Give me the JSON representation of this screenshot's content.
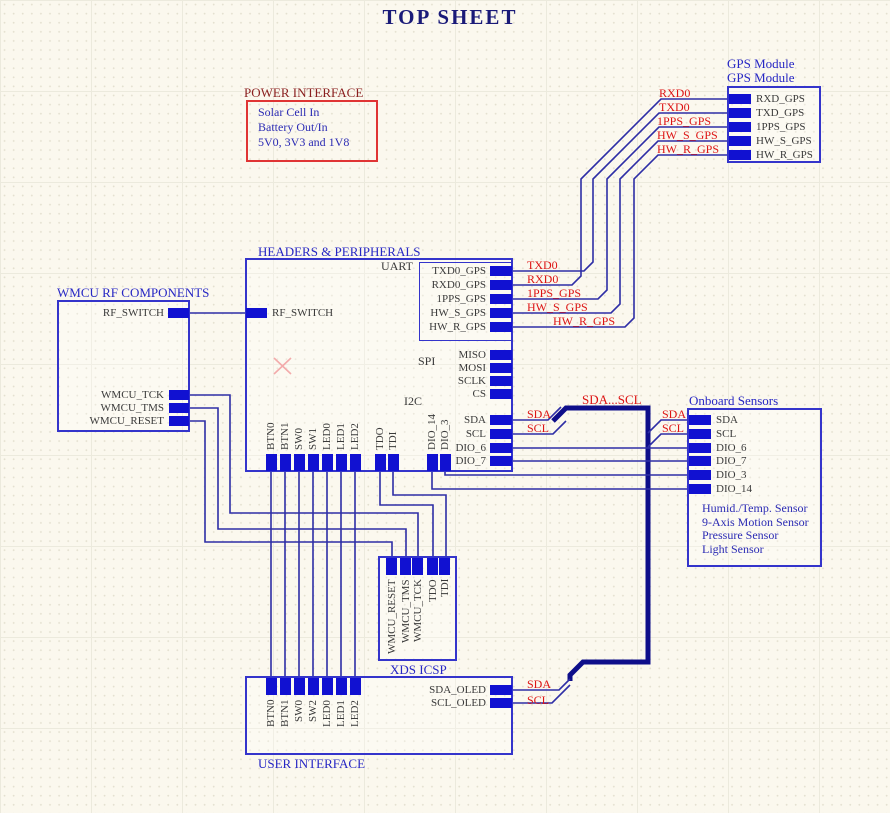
{
  "title": "TOP SHEET",
  "power": {
    "label": "POWER INTERFACE",
    "line1": "Solar Cell In",
    "line2": "Battery Out/In",
    "line3": "5V0, 3V3 and 1V8"
  },
  "gps": {
    "name": "GPS Module",
    "file": "GPS Module",
    "pins": [
      "RXD_GPS",
      "TXD_GPS",
      "1PPS_GPS",
      "HW_S_GPS",
      "HW_R_GPS"
    ]
  },
  "headers": {
    "label": "HEADERS & PERIPHERALS",
    "uart_label": "UART",
    "spi_label": "SPI",
    "i2c_label": "I2C",
    "left_pin": "RF_SWITCH",
    "uart_pins": [
      "TXD0_GPS",
      "RXD0_GPS",
      "1PPS_GPS",
      "HW_S_GPS",
      "HW_R_GPS"
    ],
    "spi_pins": [
      "MISO",
      "MOSI",
      "SCLK",
      "CS"
    ],
    "i2c_pins": [
      "SDA",
      "SCL",
      "DIO_6",
      "DIO_7"
    ],
    "bottom_pins": [
      "BTN0",
      "BTN1",
      "SW0",
      "SW1",
      "LED0",
      "LED1",
      "LED2",
      "TDO",
      "TDI",
      "DIO_14",
      "DIO_3"
    ]
  },
  "rf": {
    "label": "WMCU RF COMPONENTS",
    "pins": [
      "RF_SWITCH",
      "WMCU_TCK",
      "WMCU_TMS",
      "WMCU_RESET"
    ]
  },
  "sensors": {
    "label": "Onboard Sensors",
    "pins": [
      "SDA",
      "SCL",
      "DIO_6",
      "DIO_7",
      "DIO_3",
      "DIO_14"
    ],
    "line1": "Humid./Temp. Sensor",
    "line2": "9-Axis Motion Sensor",
    "line3": "Pressure Sensor",
    "line4": "Light Sensor"
  },
  "xds": {
    "label": "XDS ICSP",
    "pins": [
      "WMCU_RESET",
      "WMCU_TMS",
      "WMCU_TCK",
      "TDO",
      "TDI"
    ]
  },
  "user": {
    "label": "USER INTERFACE",
    "top_pins": [
      "BTN0",
      "BTN1",
      "SW0",
      "SW2",
      "LED0",
      "LED1",
      "LED2"
    ],
    "right_pins": [
      "SDA_OLED",
      "SCL_OLED"
    ]
  },
  "nets": {
    "gps_side": [
      "RXD0",
      "TXD0",
      "1PPS_GPS",
      "HW_S_GPS",
      "HW_R_GPS"
    ],
    "uart_side": [
      "TXD0",
      "RXD0",
      "1PPS_GPS",
      "HW_S_GPS",
      "HW_R_GPS"
    ],
    "bus": "SDA...SCL",
    "sensor_sda": "SDA",
    "sensor_scl": "SCL",
    "oled_sda": "SDA",
    "oled_scl": "SCL"
  }
}
